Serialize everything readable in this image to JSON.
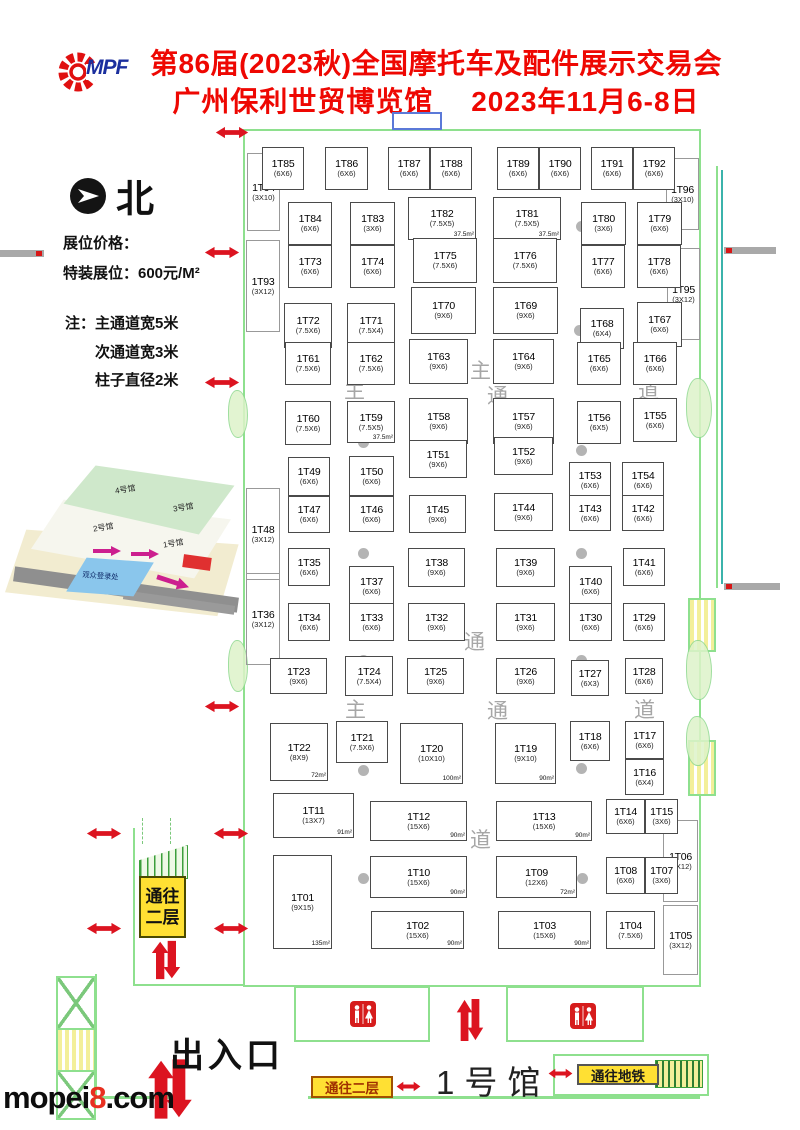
{
  "header": {
    "logo_mpf": "MPF",
    "title_line1": "第86届(2023秋)全国摩托车及配件展示交易会",
    "title_line2": "广州保利世贸博览馆　 2023年11月6-8日"
  },
  "legend": {
    "north": "北",
    "price_heading": "展位价格：",
    "price_special": "特装展位：600元/M²",
    "note_heading": "注：",
    "notes": [
      "主通道宽5米",
      "次通道宽3米",
      "柱子直径2米"
    ]
  },
  "inset": {
    "labels": [
      "4号馆",
      "3号馆",
      "2号馆",
      "1号馆",
      "观众登录处"
    ]
  },
  "signs": {
    "to_second_floor_lines": [
      "通往",
      "二层"
    ],
    "to_second_floor": "通往二层",
    "to_subway": "通往地铁"
  },
  "hall": {
    "entrance_label": "出入口",
    "hall_label": "1号馆"
  },
  "watermark": {
    "prefix": "mopei",
    "accent": "8",
    "suffix": ".com"
  },
  "booths": [
    {
      "id": "1T85",
      "size": "(6X6)",
      "x": 262,
      "y": 147,
      "w": 42,
      "h": 43
    },
    {
      "id": "1T86",
      "size": "(6X6)",
      "x": 325,
      "y": 147,
      "w": 43,
      "h": 43
    },
    {
      "id": "1T87",
      "size": "(6X6)",
      "x": 388,
      "y": 147,
      "w": 42,
      "h": 43
    },
    {
      "id": "1T88",
      "size": "(6X6)",
      "x": 430,
      "y": 147,
      "w": 42,
      "h": 43
    },
    {
      "id": "1T89",
      "size": "(6X6)",
      "x": 497,
      "y": 147,
      "w": 42,
      "h": 43
    },
    {
      "id": "1T90",
      "size": "(6X6)",
      "x": 539,
      "y": 147,
      "w": 42,
      "h": 43
    },
    {
      "id": "1T91",
      "size": "(6X6)",
      "x": 591,
      "y": 147,
      "w": 42,
      "h": 43
    },
    {
      "id": "1T92",
      "size": "(6X6)",
      "x": 633,
      "y": 147,
      "w": 42,
      "h": 43
    },
    {
      "id": "1T94",
      "size": "(3X10)",
      "x": 247,
      "y": 153,
      "w": 33,
      "h": 78,
      "side": true
    },
    {
      "id": "1T96",
      "size": "(3X10)",
      "x": 666,
      "y": 158,
      "w": 33,
      "h": 72,
      "side": true
    },
    {
      "id": "1T84",
      "size": "(6X6)",
      "x": 288,
      "y": 202,
      "w": 44,
      "h": 43
    },
    {
      "id": "1T83",
      "size": "(3X6)",
      "x": 350,
      "y": 202,
      "w": 45,
      "h": 43
    },
    {
      "id": "1T82",
      "size": "(7.5X5)",
      "a": "37.5m²",
      "x": 408,
      "y": 197,
      "w": 68,
      "h": 43
    },
    {
      "id": "1T81",
      "size": "(7.5X5)",
      "a": "37.5m²",
      "x": 493,
      "y": 197,
      "w": 68,
      "h": 43
    },
    {
      "id": "1T80",
      "size": "(3X6)",
      "x": 581,
      "y": 202,
      "w": 45,
      "h": 43
    },
    {
      "id": "1T79",
      "size": "(6X6)",
      "x": 637,
      "y": 202,
      "w": 45,
      "h": 43
    },
    {
      "id": "1T93",
      "size": "(3X12)",
      "x": 246,
      "y": 240,
      "w": 34,
      "h": 92,
      "side": true
    },
    {
      "id": "1T95",
      "size": "(3X12)",
      "x": 667,
      "y": 248,
      "w": 33,
      "h": 92,
      "side": true
    },
    {
      "id": "1T73",
      "size": "(6X6)",
      "x": 288,
      "y": 245,
      "w": 44,
      "h": 43
    },
    {
      "id": "1T74",
      "size": "(6X6)",
      "x": 350,
      "y": 245,
      "w": 45,
      "h": 43
    },
    {
      "id": "1T75",
      "size": "(7.5X6)",
      "x": 413,
      "y": 238,
      "w": 64,
      "h": 45
    },
    {
      "id": "1T76",
      "size": "(7.5X6)",
      "x": 493,
      "y": 238,
      "w": 64,
      "h": 45
    },
    {
      "id": "1T77",
      "size": "(6X6)",
      "x": 581,
      "y": 245,
      "w": 44,
      "h": 43
    },
    {
      "id": "1T78",
      "size": "(6X6)",
      "x": 637,
      "y": 245,
      "w": 44,
      "h": 43
    },
    {
      "id": "1T72",
      "size": "(7.5X6)",
      "x": 284,
      "y": 303,
      "w": 48,
      "h": 45
    },
    {
      "id": "1T71",
      "size": "(7.5X4)",
      "x": 347,
      "y": 303,
      "w": 48,
      "h": 45
    },
    {
      "id": "1T70",
      "size": "(9X6)",
      "x": 411,
      "y": 287,
      "w": 65,
      "h": 47
    },
    {
      "id": "1T69",
      "size": "(9X6)",
      "x": 493,
      "y": 287,
      "w": 65,
      "h": 47
    },
    {
      "id": "1T68",
      "size": "(6X4)",
      "x": 580,
      "y": 308,
      "w": 44,
      "h": 41
    },
    {
      "id": "1T67",
      "size": "(6X6)",
      "x": 637,
      "y": 302,
      "w": 45,
      "h": 45
    },
    {
      "id": "1T61",
      "size": "(7.5X6)",
      "x": 285,
      "y": 342,
      "w": 46,
      "h": 43
    },
    {
      "id": "1T62",
      "size": "(7.5X6)",
      "x": 347,
      "y": 342,
      "w": 48,
      "h": 43
    },
    {
      "id": "1T63",
      "size": "(9X6)",
      "x": 409,
      "y": 339,
      "w": 59,
      "h": 45
    },
    {
      "id": "1T64",
      "size": "(9X6)",
      "x": 493,
      "y": 339,
      "w": 61,
      "h": 45
    },
    {
      "id": "1T65",
      "size": "(6X6)",
      "x": 577,
      "y": 342,
      "w": 44,
      "h": 43
    },
    {
      "id": "1T66",
      "size": "(6X6)",
      "x": 633,
      "y": 342,
      "w": 44,
      "h": 43
    },
    {
      "id": "1T60",
      "size": "(7.5X6)",
      "x": 285,
      "y": 401,
      "w": 46,
      "h": 44
    },
    {
      "id": "1T59",
      "size": "(7.5X5)",
      "a": "37.5m²",
      "x": 347,
      "y": 401,
      "w": 48,
      "h": 42
    },
    {
      "id": "1T58",
      "size": "(9X6)",
      "x": 409,
      "y": 398,
      "w": 59,
      "h": 46
    },
    {
      "id": "1T57",
      "size": "(9X6)",
      "x": 493,
      "y": 398,
      "w": 61,
      "h": 46
    },
    {
      "id": "1T56",
      "size": "(6X5)",
      "x": 577,
      "y": 401,
      "w": 44,
      "h": 43
    },
    {
      "id": "1T55",
      "size": "(6X6)",
      "x": 633,
      "y": 398,
      "w": 44,
      "h": 44
    },
    {
      "id": "1T51",
      "size": "(9X6)",
      "x": 409,
      "y": 440,
      "w": 58,
      "h": 38
    },
    {
      "id": "1T52",
      "size": "(9X6)",
      "x": 494,
      "y": 437,
      "w": 59,
      "h": 38
    },
    {
      "id": "1T49",
      "size": "(6X6)",
      "x": 288,
      "y": 457,
      "w": 42,
      "h": 39
    },
    {
      "id": "1T50",
      "size": "(6X6)",
      "x": 349,
      "y": 456,
      "w": 45,
      "h": 40
    },
    {
      "id": "1T53",
      "size": "(6X6)",
      "x": 569,
      "y": 462,
      "w": 42,
      "h": 36
    },
    {
      "id": "1T54",
      "size": "(6X6)",
      "x": 622,
      "y": 462,
      "w": 42,
      "h": 36
    },
    {
      "id": "1T48",
      "size": "(3X12)",
      "x": 246,
      "y": 488,
      "w": 34,
      "h": 92,
      "side": true
    },
    {
      "id": "1T47",
      "size": "(6X6)",
      "x": 288,
      "y": 496,
      "w": 42,
      "h": 37
    },
    {
      "id": "1T46",
      "size": "(6X6)",
      "x": 349,
      "y": 496,
      "w": 45,
      "h": 36
    },
    {
      "id": "1T45",
      "size": "(9X6)",
      "x": 409,
      "y": 495,
      "w": 57,
      "h": 38
    },
    {
      "id": "1T44",
      "size": "(9X6)",
      "x": 494,
      "y": 493,
      "w": 59,
      "h": 38
    },
    {
      "id": "1T43",
      "size": "(6X6)",
      "x": 569,
      "y": 495,
      "w": 42,
      "h": 36
    },
    {
      "id": "1T42",
      "size": "(6X6)",
      "x": 622,
      "y": 495,
      "w": 42,
      "h": 36
    },
    {
      "id": "1T36",
      "size": "(3X12)",
      "x": 246,
      "y": 573,
      "w": 34,
      "h": 92,
      "side": true
    },
    {
      "id": "1T35",
      "size": "(6X6)",
      "x": 288,
      "y": 548,
      "w": 42,
      "h": 38
    },
    {
      "id": "1T37",
      "size": "(6X6)",
      "x": 349,
      "y": 566,
      "w": 45,
      "h": 40
    },
    {
      "id": "1T38",
      "size": "(9X6)",
      "x": 408,
      "y": 548,
      "w": 57,
      "h": 39
    },
    {
      "id": "1T39",
      "size": "(9X6)",
      "x": 496,
      "y": 548,
      "w": 59,
      "h": 39
    },
    {
      "id": "1T40",
      "size": "(6X6)",
      "x": 569,
      "y": 566,
      "w": 43,
      "h": 40
    },
    {
      "id": "1T41",
      "size": "(6X6)",
      "x": 623,
      "y": 548,
      "w": 42,
      "h": 38
    },
    {
      "id": "1T34",
      "size": "(6X6)",
      "x": 288,
      "y": 603,
      "w": 42,
      "h": 38
    },
    {
      "id": "1T33",
      "size": "(6X6)",
      "x": 349,
      "y": 603,
      "w": 45,
      "h": 38
    },
    {
      "id": "1T32",
      "size": "(9X6)",
      "x": 408,
      "y": 603,
      "w": 57,
      "h": 38
    },
    {
      "id": "1T31",
      "size": "(9X6)",
      "x": 496,
      "y": 603,
      "w": 59,
      "h": 38
    },
    {
      "id": "1T30",
      "size": "(6X6)",
      "x": 569,
      "y": 603,
      "w": 43,
      "h": 38
    },
    {
      "id": "1T29",
      "size": "(6X6)",
      "x": 623,
      "y": 603,
      "w": 42,
      "h": 38
    },
    {
      "id": "1T23",
      "size": "(9X6)",
      "x": 270,
      "y": 658,
      "w": 57,
      "h": 36
    },
    {
      "id": "1T24",
      "size": "(7.5X4)",
      "x": 345,
      "y": 656,
      "w": 48,
      "h": 40
    },
    {
      "id": "1T25",
      "size": "(9X6)",
      "x": 407,
      "y": 658,
      "w": 57,
      "h": 36
    },
    {
      "id": "1T26",
      "size": "(9X6)",
      "x": 496,
      "y": 658,
      "w": 59,
      "h": 36
    },
    {
      "id": "1T27",
      "size": "(6X3)",
      "x": 571,
      "y": 660,
      "w": 38,
      "h": 36
    },
    {
      "id": "1T28",
      "size": "(6X6)",
      "x": 625,
      "y": 658,
      "w": 38,
      "h": 36
    },
    {
      "id": "1T22",
      "size": "(8X9)",
      "a": "72m²",
      "x": 270,
      "y": 723,
      "w": 58,
      "h": 58
    },
    {
      "id": "1T21",
      "size": "(7.5X6)",
      "x": 336,
      "y": 721,
      "w": 52,
      "h": 42
    },
    {
      "id": "1T20",
      "size": "(10X10)",
      "a": "100m²",
      "x": 400,
      "y": 723,
      "w": 63,
      "h": 61
    },
    {
      "id": "1T19",
      "size": "(9X10)",
      "a": "90m²",
      "x": 495,
      "y": 723,
      "w": 61,
      "h": 61
    },
    {
      "id": "1T18",
      "size": "(6X6)",
      "x": 570,
      "y": 721,
      "w": 40,
      "h": 40
    },
    {
      "id": "1T17",
      "size": "(6X6)",
      "x": 625,
      "y": 721,
      "w": 39,
      "h": 38
    },
    {
      "id": "1T16",
      "size": "(6X4)",
      "x": 625,
      "y": 759,
      "w": 39,
      "h": 36
    },
    {
      "id": "1T11",
      "size": "(13X7)",
      "a": "91m²",
      "x": 273,
      "y": 793,
      "w": 81,
      "h": 45
    },
    {
      "id": "1T12",
      "size": "(15X6)",
      "a": "90m²",
      "x": 370,
      "y": 801,
      "w": 97,
      "h": 40
    },
    {
      "id": "1T13",
      "size": "(15X6)",
      "a": "90m²",
      "x": 496,
      "y": 801,
      "w": 96,
      "h": 40
    },
    {
      "id": "1T14",
      "size": "(6X6)",
      "x": 606,
      "y": 799,
      "w": 39,
      "h": 35
    },
    {
      "id": "1T15",
      "size": "(3X6)",
      "x": 645,
      "y": 799,
      "w": 33,
      "h": 35
    },
    {
      "id": "1T06",
      "size": "(3X12)",
      "x": 663,
      "y": 820,
      "w": 35,
      "h": 82,
      "side": true
    },
    {
      "id": "1T01",
      "size": "(9X15)",
      "a": "135m²",
      "x": 273,
      "y": 855,
      "w": 59,
      "h": 94
    },
    {
      "id": "1T10",
      "size": "(15X6)",
      "a": "90m²",
      "x": 370,
      "y": 856,
      "w": 97,
      "h": 42
    },
    {
      "id": "1T09",
      "size": "(12X6)",
      "a": "72m²",
      "x": 496,
      "y": 856,
      "w": 81,
      "h": 42
    },
    {
      "id": "1T08",
      "size": "(6X6)",
      "x": 606,
      "y": 857,
      "w": 39,
      "h": 37
    },
    {
      "id": "1T07",
      "size": "(3X6)",
      "x": 645,
      "y": 857,
      "w": 33,
      "h": 37
    },
    {
      "id": "1T02",
      "size": "(15X6)",
      "a": "90m²",
      "x": 371,
      "y": 911,
      "w": 93,
      "h": 38
    },
    {
      "id": "1T03",
      "size": "(15X6)",
      "a": "90m²",
      "x": 498,
      "y": 911,
      "w": 93,
      "h": 38
    },
    {
      "id": "1T04",
      "size": "(7.5X6)",
      "x": 606,
      "y": 911,
      "w": 49,
      "h": 38
    },
    {
      "id": "1T05",
      "size": "(3X12)",
      "x": 663,
      "y": 905,
      "w": 35,
      "h": 70,
      "side": true
    }
  ],
  "aisle_labels": [
    {
      "t": "主",
      "x": 344,
      "y": 375
    },
    {
      "t": "通",
      "x": 487,
      "y": 380
    },
    {
      "t": "道",
      "x": 638,
      "y": 375
    },
    {
      "t": "主",
      "x": 470,
      "y": 355
    },
    {
      "t": "通",
      "x": 464,
      "y": 626
    },
    {
      "t": "道",
      "x": 470,
      "y": 824
    },
    {
      "t": "主",
      "x": 345,
      "y": 694
    },
    {
      "t": "通",
      "x": 487,
      "y": 695
    },
    {
      "t": "道",
      "x": 634,
      "y": 694
    }
  ],
  "arrows_h": [
    {
      "x": 215,
      "y": 126,
      "w": 34,
      "h": 13
    },
    {
      "x": 204,
      "y": 246,
      "w": 36,
      "h": 13
    },
    {
      "x": 204,
      "y": 376,
      "w": 36,
      "h": 13
    },
    {
      "x": 204,
      "y": 700,
      "w": 36,
      "h": 13
    },
    {
      "x": 213,
      "y": 827,
      "w": 36,
      "h": 13
    },
    {
      "x": 213,
      "y": 922,
      "w": 36,
      "h": 13
    },
    {
      "x": 86,
      "y": 827,
      "w": 36,
      "h": 13
    },
    {
      "x": 86,
      "y": 922,
      "w": 36,
      "h": 13
    },
    {
      "x": 396,
      "y": 1079,
      "w": 25,
      "h": 11
    },
    {
      "x": 548,
      "y": 1066,
      "w": 25,
      "h": 11
    }
  ],
  "arrows_v": [
    {
      "x": 151,
      "y": 940,
      "w": 30,
      "h": 40
    },
    {
      "x": 456,
      "y": 998,
      "w": 28,
      "h": 44
    },
    {
      "x": 147,
      "y": 1058,
      "w": 46,
      "h": 62
    }
  ],
  "pillars": [
    {
      "x": 358,
      "y": 221
    },
    {
      "x": 576,
      "y": 221
    },
    {
      "x": 358,
      "y": 332
    },
    {
      "x": 574,
      "y": 325
    },
    {
      "x": 358,
      "y": 437
    },
    {
      "x": 576,
      "y": 445
    },
    {
      "x": 358,
      "y": 548
    },
    {
      "x": 576,
      "y": 548
    },
    {
      "x": 358,
      "y": 655
    },
    {
      "x": 576,
      "y": 655
    },
    {
      "x": 358,
      "y": 765
    },
    {
      "x": 576,
      "y": 763
    },
    {
      "x": 358,
      "y": 873
    },
    {
      "x": 577,
      "y": 873
    }
  ]
}
